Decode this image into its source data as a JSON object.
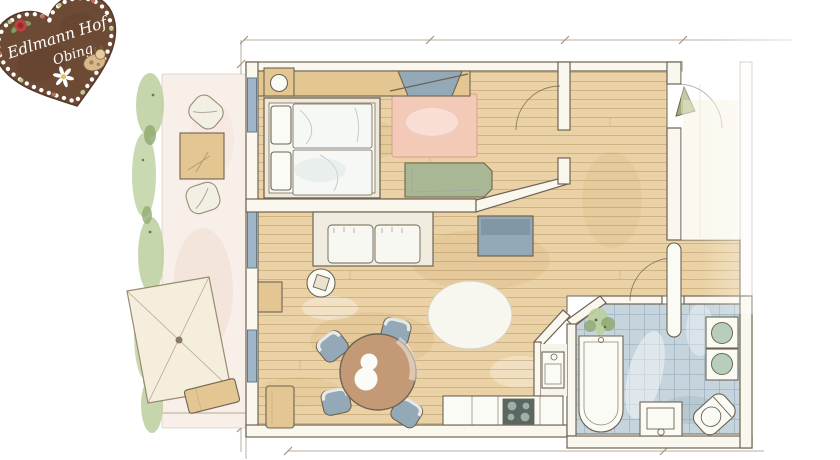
{
  "logo": {
    "line1": "Edlmann Hof",
    "line2": "Obing"
  },
  "palette": {
    "paper": "#ffffff",
    "wood": "#ead2a6",
    "woodLine": "#b3935f",
    "woodShade": "#d9b67e",
    "wallFill": "#faf7ef",
    "wallStroke": "#6e6352",
    "sketch": "#9a8b73",
    "tan": "#e3c692",
    "pinkRug": "#f3c9b8",
    "greenBench": "#a9b795",
    "blueGray": "#94a9b7",
    "windowBlue": "#9fb6c9",
    "tileBlue": "#c5d4dd",
    "tileLine": "#8ba4b4",
    "basinGreen": "#b7cfba",
    "tableBrown": "#c49a76",
    "doorGreen": "#a3ad74",
    "leafGreen": "#bccf9e",
    "leafGreenDark": "#8fa86f",
    "heartBrown": "#6d4a33",
    "heartDark": "#57392a",
    "roseRed": "#bf4040"
  },
  "depicts": [
    "gingerbread-heart-logo",
    "balcony",
    "parasol",
    "sun-lounger",
    "garden-chairs",
    "bedroom",
    "double-bed",
    "wardrobe",
    "desk-chair",
    "pink-rug",
    "daybed-bench",
    "living-room",
    "sofa",
    "side-table",
    "tv-cabinet",
    "oval-rug",
    "dining-table",
    "dining-chairs",
    "kitchenette",
    "cooktop",
    "entry-door",
    "hallway",
    "bathroom",
    "bathtub",
    "double-washbasin",
    "toilet",
    "shower-tray",
    "plant"
  ]
}
